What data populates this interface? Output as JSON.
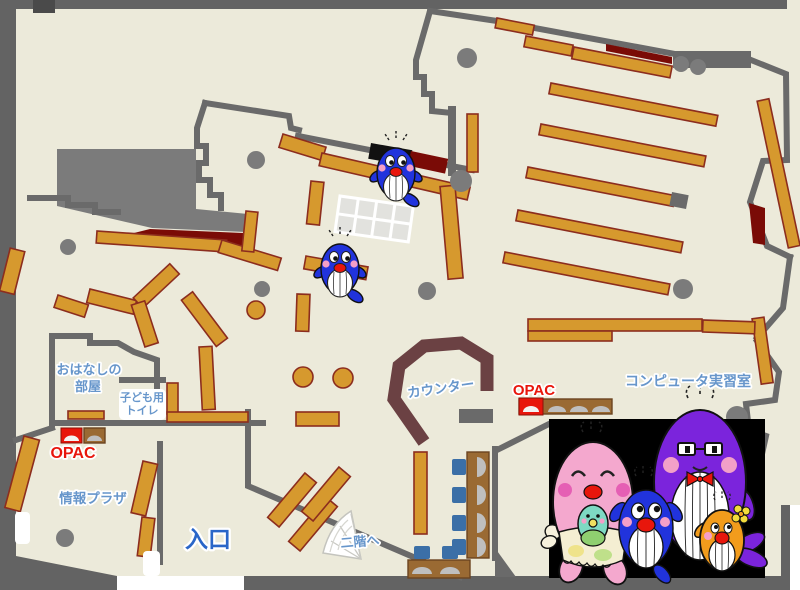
{
  "map": {
    "labels": {
      "storytelling_room_line1": "おはなしの",
      "storytelling_room_line2": "部屋",
      "kids_toilet_line1": "子ども用",
      "kids_toilet_line2": "トイレ",
      "opac_left": "OPAC",
      "opac_right": "OPAC",
      "info_plaza": "情報プラザ",
      "entrance": "入口",
      "counter": "カウンター",
      "computer_room": "コンピュータ実習室",
      "to_second_floor": "二階へ"
    },
    "colors": {
      "floor": "#ECEADA",
      "wall": "#6A6A6A",
      "frame": "#636363",
      "blob": "#7B7B7B",
      "shelf_fill": "#D6992E",
      "shelf_stroke": "#8C2D1E",
      "dark_red": "#7A0B06",
      "counter": "#6B4143",
      "desk_brown": "#9A6A33",
      "chair_blue": "#3B6FA7",
      "monitor_gray": "#BFBFBF",
      "table_gray": "#E2E2DE",
      "label_blue": "#6796CB",
      "entrance_blue": "#2A66C8",
      "opac_red": "#E8160C",
      "panel_black": "#000000",
      "mascot_blue": "#2133DC",
      "mascot_pink": "#F4A8CE",
      "mascot_purple": "#7B24DC",
      "mascot_orange": "#F29C1C",
      "mascot_teal": "#7ED9C3"
    },
    "mascots": {
      "floor": [
        "blue-whale-mascot",
        "blue-whale-mascot"
      ],
      "family_panel": [
        "pink-mother-whale",
        "teal-baby-whale",
        "blue-child-whale",
        "purple-father-whale",
        "orange-child-whale"
      ]
    }
  }
}
